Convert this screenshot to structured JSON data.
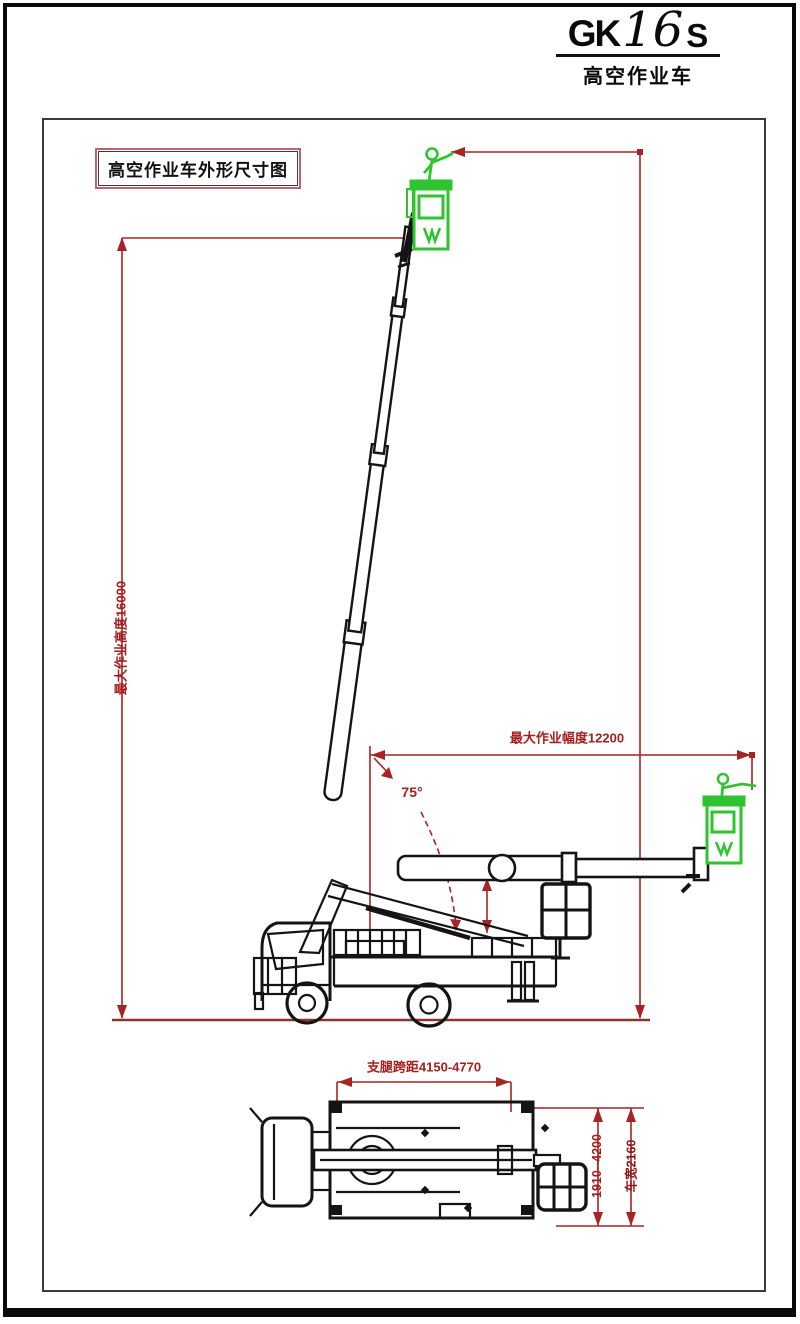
{
  "title_block": {
    "model_gk": "GK",
    "model_num": "16",
    "model_s": "S",
    "subtitle": "高空作业车"
  },
  "drawing": {
    "label_box_text": "高空作业车外形尺寸图",
    "side_view": {
      "max_height_label": "最大作业高度16000",
      "max_radius_label": "最大作业幅度12200",
      "boom_angle_label": "75°"
    },
    "top_view": {
      "outrigger_span_label": "支腿跨距4150-4770",
      "lateral_span_label": "1910--4200",
      "width_label": "车宽2160"
    },
    "colors": {
      "dimension_red": "#a61e1e",
      "bucket_green": "#2fc42f",
      "line_ink": "#141414"
    }
  }
}
